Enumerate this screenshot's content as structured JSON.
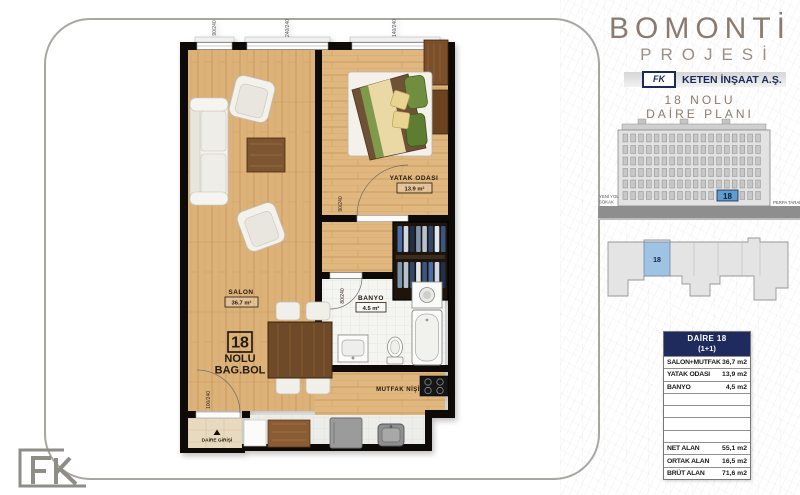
{
  "brand": {
    "title": "BOMONTİ",
    "subtitle": "PROJESİ",
    "company": "KETEN İNŞAAT A.Ş.",
    "logo_text": "FK",
    "plan_no_line": "18 NOLU",
    "plan_title_line": "DAİRE PLANI"
  },
  "colors": {
    "navy": "#1b2a5a",
    "elevation_highlight": "#5f9dcc",
    "floorplate_highlight": "#9fc3e2",
    "title_brown": "#8a7b6e"
  },
  "elevation": {
    "street_label_line1": "YENİ YOL",
    "street_label_line2": "SOKAK",
    "side_label": "PERPA TARAFI",
    "unit_number": "18"
  },
  "floorplate": {
    "unit_number": "18"
  },
  "unit_table": {
    "title_line1": "DAİRE 18",
    "title_line2": "(1+1)",
    "rows": [
      {
        "label": "SALON+MUTFAK",
        "value": "36,7 m2"
      },
      {
        "label": "YATAK ODASI",
        "value": "13,9 m2"
      },
      {
        "label": "BANYO",
        "value": "4,5 m2"
      },
      {
        "label": "",
        "value": ""
      },
      {
        "label": "",
        "value": ""
      },
      {
        "label": "",
        "value": ""
      },
      {
        "label": "",
        "value": ""
      },
      {
        "label": "NET ALAN",
        "value": "55,1 m2"
      },
      {
        "label": "ORTAK ALAN",
        "value": "16,5 m2"
      },
      {
        "label": "BRÜT ALAN",
        "value": "71,6 m2"
      }
    ]
  },
  "floorplan": {
    "rooms": {
      "salon": {
        "name": "SALON",
        "area": "36.7 m²"
      },
      "bedroom": {
        "name": "YATAK ODASI",
        "area": "13.9 m²"
      },
      "bathroom": {
        "name": "BANYO",
        "area": "4.5 m²"
      },
      "kitchen": {
        "name": "MUTFAK NİŞİ"
      }
    },
    "unit_mark": {
      "number": "18",
      "line1": "NOLU",
      "line2": "BAG.BOL"
    },
    "entrance": {
      "label": "DAİRE GİRİŞİ"
    },
    "dims": {
      "window_left": "90/240",
      "window_mid": "240/240",
      "window_right": "140/240",
      "bedroom_door": "90/240",
      "bath_door": "80/240",
      "entry_door": "100/240"
    }
  },
  "footer": {
    "logo_text": "FK"
  }
}
